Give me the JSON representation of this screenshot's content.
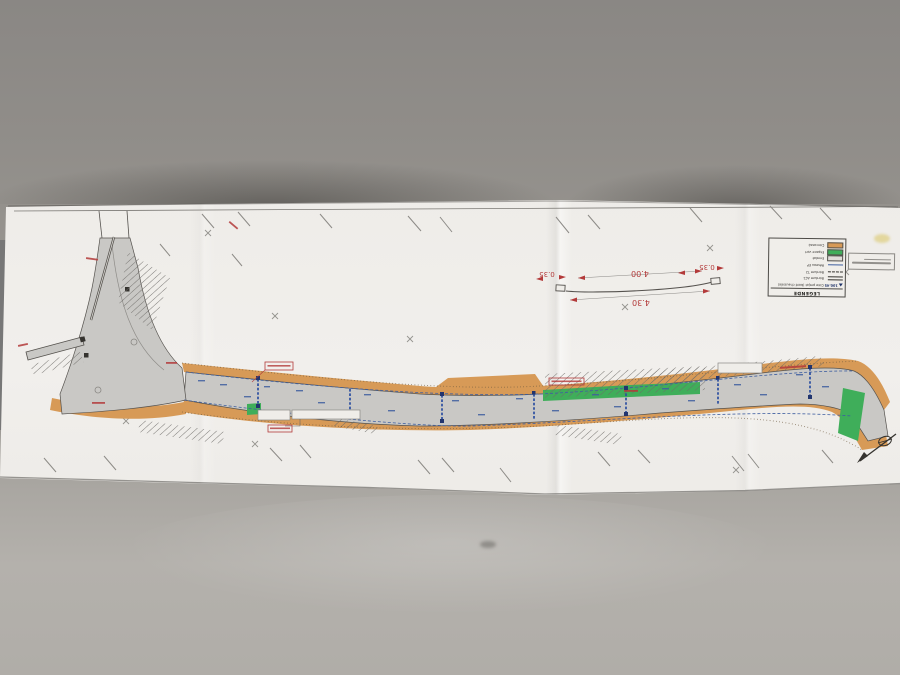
{
  "photo": {
    "background_top": "#8f8c88",
    "desk_surface": "#aaa7a2",
    "paper_color": "#efede9"
  },
  "plan": {
    "colors": {
      "road_gray": "#c9c8c5",
      "sidewalk_orange": "#d79a57",
      "green_area": "#3fae5a",
      "drainage_blue": "#3f5fa0",
      "section_blue": "#2b4ea0",
      "annotation_red": "#b33a3a",
      "line_dark": "#55524e"
    },
    "cross_section": {
      "dim_inner": "4.00",
      "dim_outer": "4.30",
      "dim_left_curb": "0.35",
      "dim_right_curb": "0.35"
    },
    "legend": {
      "title": "LEGENDE",
      "rows": [
        {
          "symbol": "spot-level",
          "label": "Cote projet (bord chaussée)",
          "value": "100.45"
        },
        {
          "symbol": "double-line",
          "label": "Bordure AC1"
        },
        {
          "symbol": "dashed-line",
          "label": "Bordure T2"
        },
        {
          "symbol": "blue-line",
          "label": "Réseau EP"
        },
        {
          "symbol": "swatch-gray",
          "label": "Enrobé"
        },
        {
          "symbol": "swatch-green",
          "label": "Espace vert"
        },
        {
          "symbol": "swatch-tan",
          "label": "Concassé"
        }
      ]
    }
  }
}
